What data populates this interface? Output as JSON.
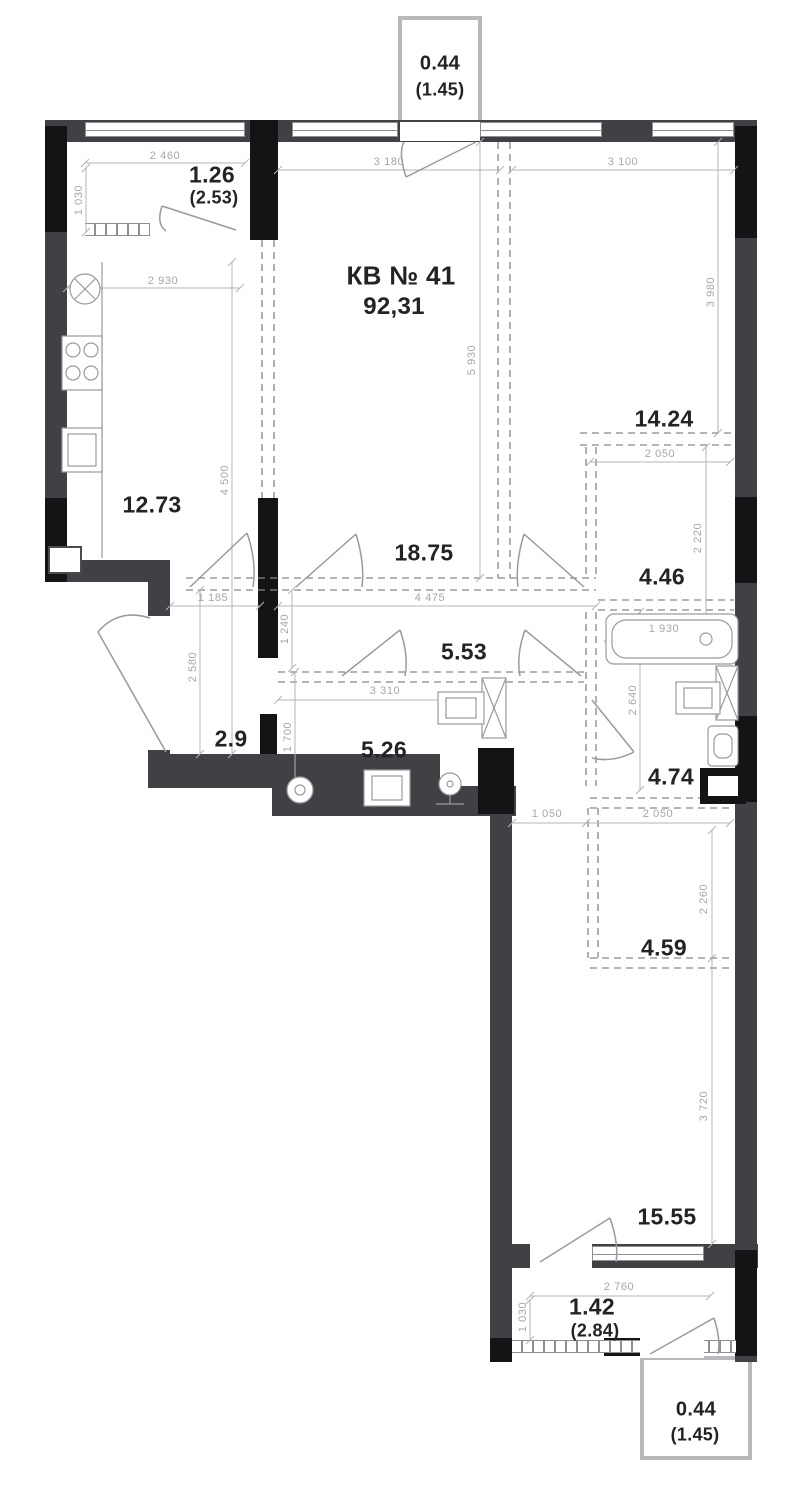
{
  "plan": {
    "title": "КВ № 41",
    "total_area": "92,31",
    "rooms": {
      "kitchen": "12.73",
      "living": "18.75",
      "bedroom_top": "14.24",
      "dressing_top": "4.46",
      "hall": "2.9",
      "corridor": "5.53",
      "bathroom": "5.26",
      "bathroom_2": "4.74",
      "dressing_bottom": "4.59",
      "bedroom_bottom": "15.55"
    },
    "balconies": {
      "top": {
        "area": "0.44",
        "full": "(1.45)"
      },
      "top_left": {
        "area": "1.26",
        "full": "(2.53)"
      },
      "bottom": {
        "area": "1.42",
        "full": "(2.84)"
      },
      "bottom_right": {
        "area": "0.44",
        "full": "(1.45)"
      }
    },
    "dims": {
      "w2460": "2 460",
      "h1030_top": "1 030",
      "w2930": "2 930",
      "h4500": "4 500",
      "w3180": "3 180",
      "w3100": "3 100",
      "h3980": "3 980",
      "h5930": "5 930",
      "w2050_top": "2 050",
      "h2220": "2 220",
      "w1185": "1 185",
      "w4475": "4 475",
      "h1240": "1 240",
      "h2580": "2 580",
      "h1700": "1 700",
      "w3310": "3 310",
      "w1930": "1 930",
      "h2640": "2 640",
      "w1050": "1 050",
      "w2050_bottom": "2 050",
      "h2260": "2 260",
      "h3720": "3 720",
      "w2760": "2 760",
      "h1030_bottom": "1 030"
    }
  }
}
